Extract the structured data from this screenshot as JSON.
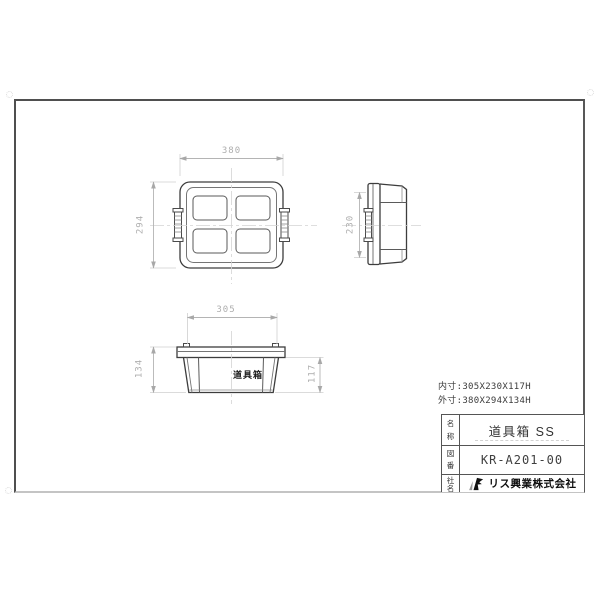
{
  "drawing": {
    "top_view": {
      "dim_width": "380",
      "dim_height": "294"
    },
    "side_view": {
      "dim_height": "230"
    },
    "front_view": {
      "dim_width": "305",
      "dim_height_outer": "134",
      "dim_height_inner": "117",
      "product_label": "道具箱"
    },
    "title_block": {
      "inner_size_label": "内寸:305X230X117H",
      "outer_size_label": "外寸:380X294X134H",
      "rows": [
        {
          "label_top": "名",
          "label_bottom": "称",
          "value": "道具箱 SS"
        },
        {
          "label_top": "図",
          "label_bottom": "番",
          "value": "KR-A201-00"
        },
        {
          "label_top": "社",
          "label_bottom": "名",
          "value": "リス興業株式会社"
        }
      ]
    },
    "colors": {
      "object_line": "#3d3d3d",
      "secondary_line": "#757575",
      "dim_line": "#b4b4b4",
      "extension_line": "#cfcfcf",
      "centerline": "#d4d4d4",
      "text_dark": "#2f2f2f",
      "logo": "#111111"
    }
  }
}
